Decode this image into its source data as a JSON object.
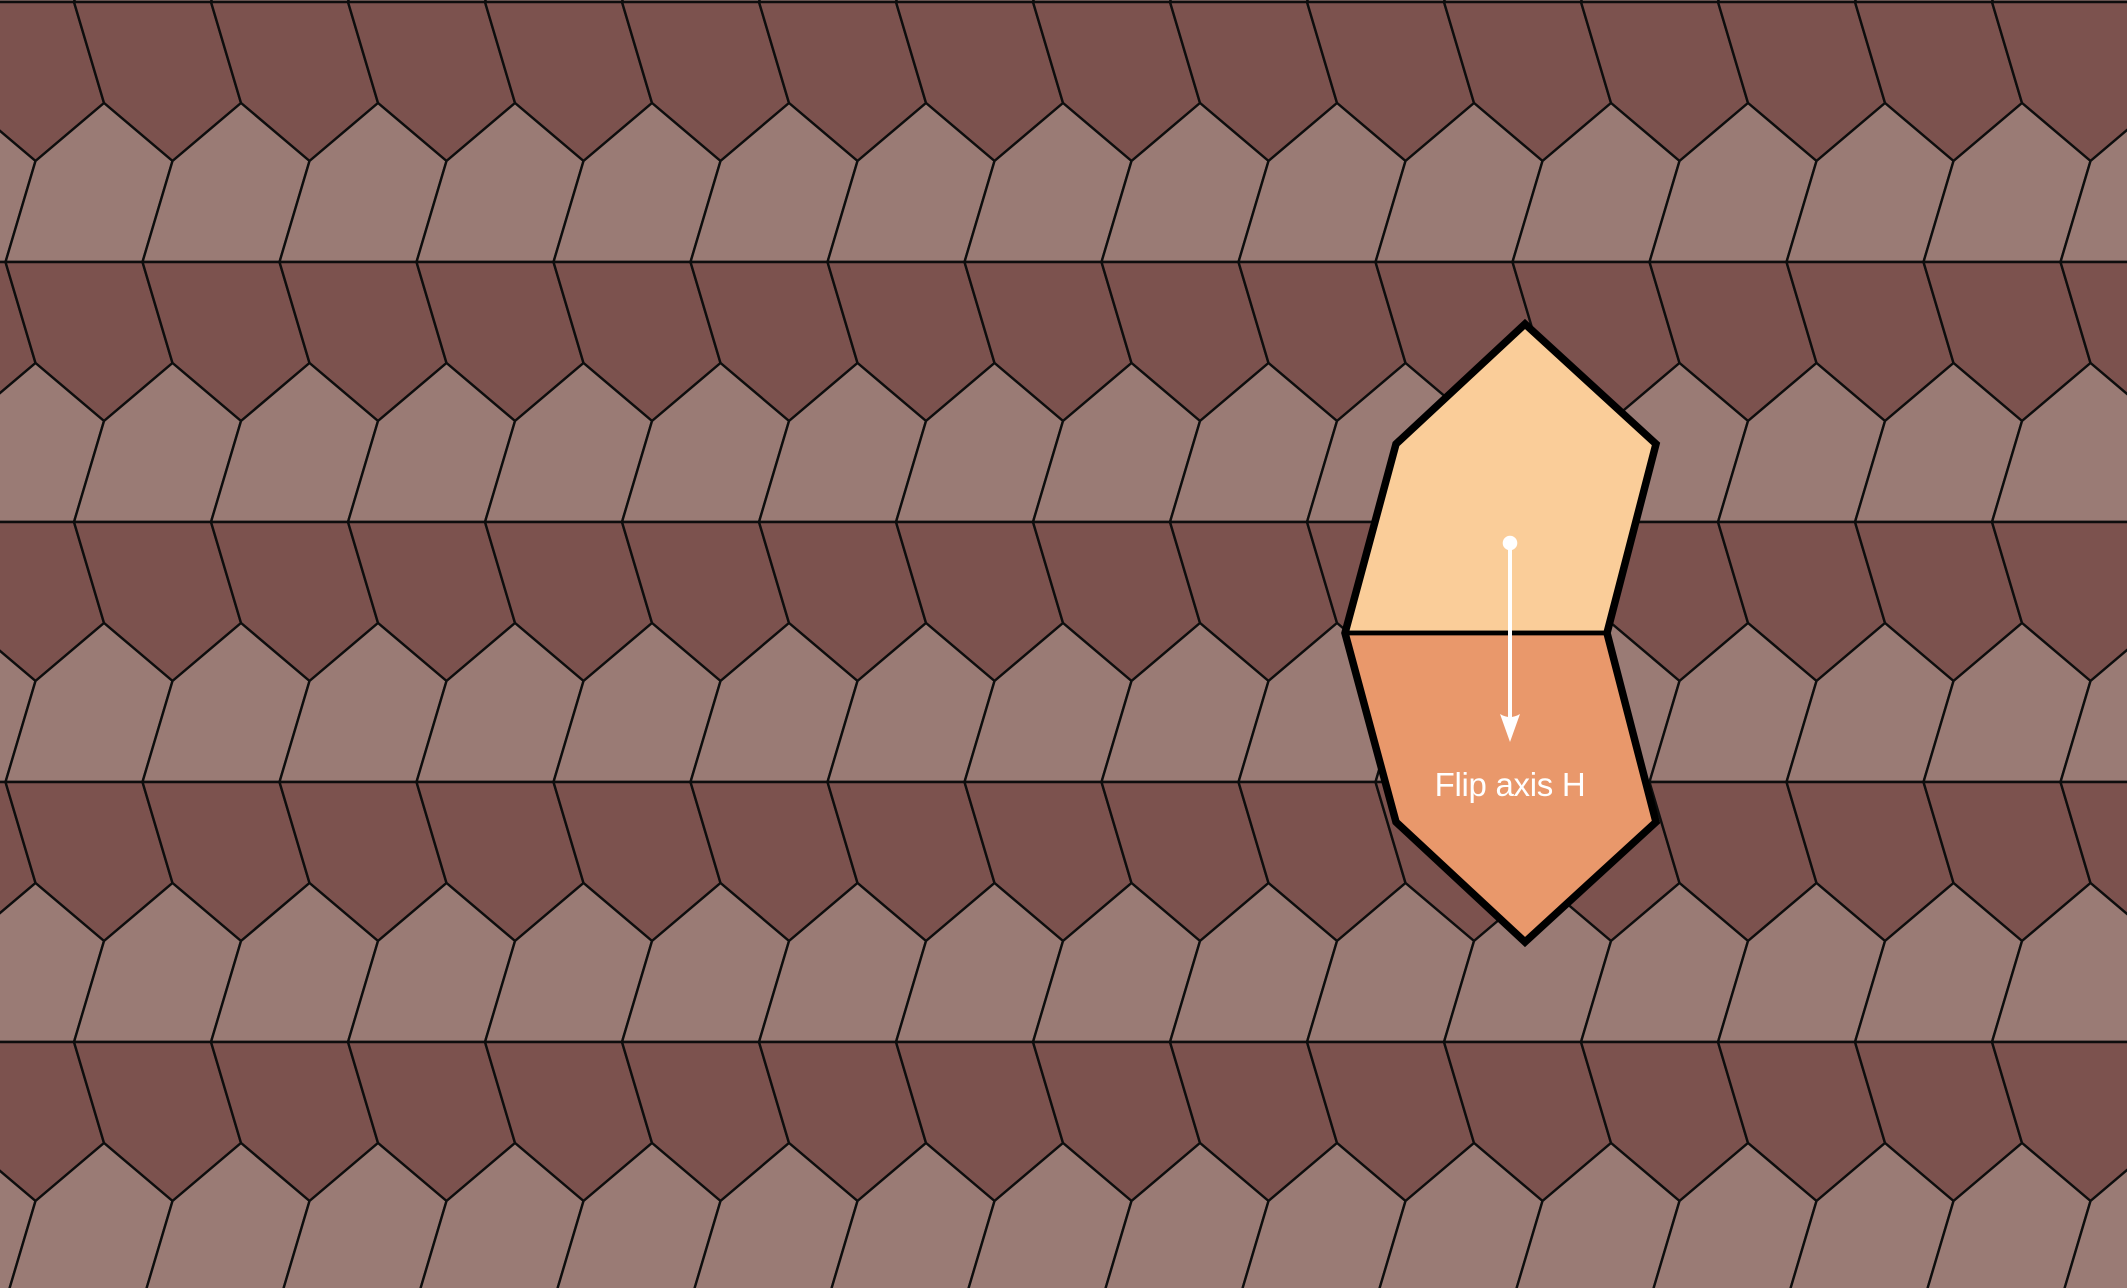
{
  "canvas": {
    "width": 2127,
    "height": 1288,
    "background": "#7C524E"
  },
  "tessellation": {
    "pentagon": {
      "width": 137,
      "side_offset": 30,
      "side_height": 101,
      "roof_height": 58,
      "apex_offset": 98.5
    },
    "band_height": 260,
    "first_line_y": 2,
    "phase_even_band": 5.5,
    "phase_odd_band": 74,
    "edge_width": 2.4,
    "colors": {
      "dark_tile": "#7C524E",
      "light_tile": "#9A7B75",
      "edge": "#0D0D0D"
    }
  },
  "overlay": {
    "top_tile": {
      "fill": "#FACD99",
      "points": [
        [
          1345,
          633
        ],
        [
          1607,
          633
        ],
        [
          1656,
          444
        ],
        [
          1525,
          324
        ],
        [
          1396,
          444
        ]
      ]
    },
    "bottom_tile": {
      "fill": "#E9986B",
      "points": [
        [
          1345,
          633
        ],
        [
          1607,
          633
        ],
        [
          1656,
          822
        ],
        [
          1525,
          942
        ],
        [
          1396,
          822
        ]
      ]
    },
    "outline_points": [
      [
        1345,
        633
      ],
      [
        1396,
        444
      ],
      [
        1525,
        324
      ],
      [
        1656,
        444
      ],
      [
        1607,
        633
      ],
      [
        1656,
        822
      ],
      [
        1525,
        942
      ],
      [
        1396,
        822
      ]
    ],
    "shared_edge": {
      "x1": 1345,
      "y1": 633,
      "x2": 1607,
      "y2": 633
    },
    "border_color": "#000000",
    "border_width": 7.5,
    "inner_edge_width": 4.5,
    "flip_control": {
      "color": "#FFFFFF",
      "dot": {
        "cx": 1510,
        "cy": 543,
        "r": 7.3
      },
      "shaft": {
        "x": 1510,
        "y1": 550,
        "y2": 730,
        "width": 4
      },
      "head": {
        "tip_x": 1510,
        "tip_y": 742,
        "half_width": 10,
        "length": 28,
        "notch": 22
      }
    },
    "label": {
      "text": "Flip axis H",
      "x": 1510,
      "y": 796,
      "font_size": 33,
      "color": "#FFFFFF"
    }
  }
}
